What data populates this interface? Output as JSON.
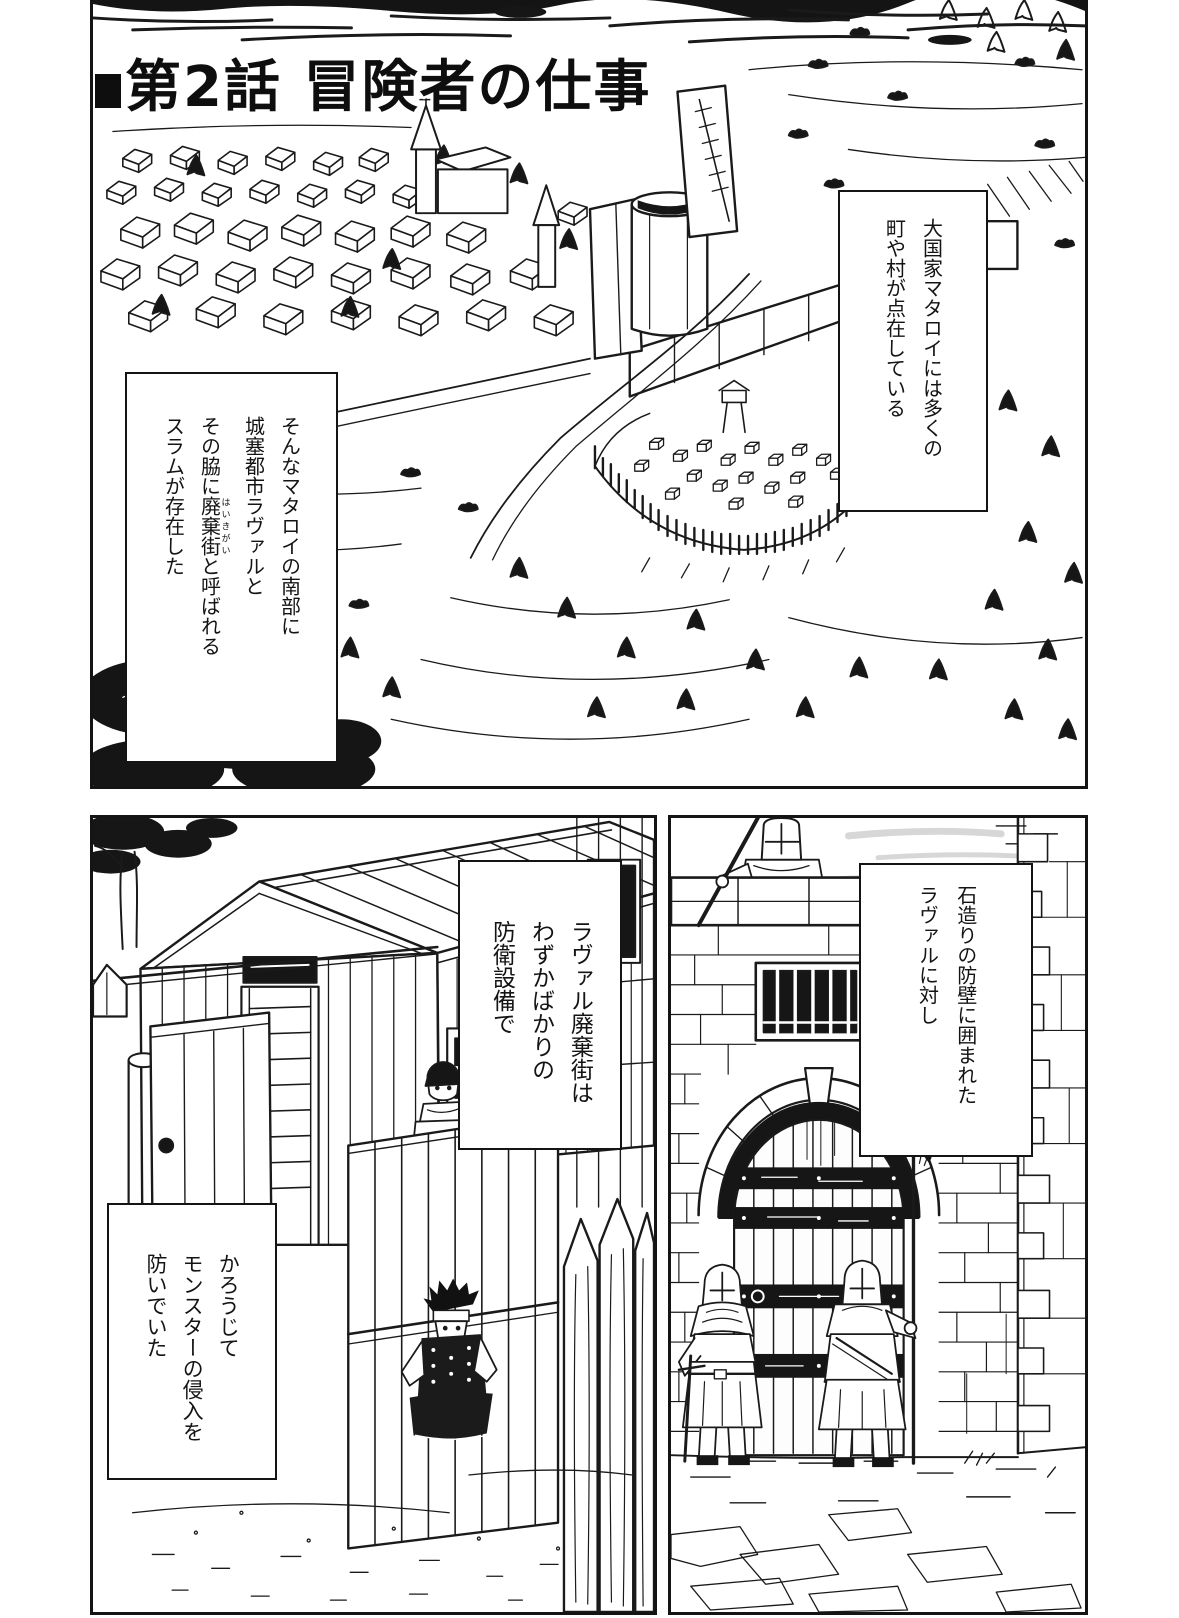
{
  "page": {
    "title": "第2話 冒険者の仕事"
  },
  "colors": {
    "ink": "#141414",
    "paper": "#ffffff"
  },
  "panels": {
    "top": {
      "caption_right": {
        "lines": [
          "大国家マタロイには多くの",
          "町や村が点在している"
        ]
      },
      "caption_left": {
        "l1": "そんなマタロイの南部に",
        "l2": "城塞都市ラヴァルと",
        "l3_pre": "その脇に",
        "l3_base": "廃棄街",
        "l3_ruby": "はいきがい",
        "l3_post": "と呼ばれる",
        "l4": "スラムが存在した"
      }
    },
    "bottom_left": {
      "caption_upper": {
        "lines": [
          "ラヴァル廃棄街は",
          "わずかばかりの",
          "防衛設備で"
        ]
      },
      "caption_lower": {
        "lines": [
          "かろうじて",
          "モンスターの侵入を",
          "防いでいた"
        ]
      }
    },
    "bottom_right": {
      "caption": {
        "lines": [
          "石造りの防壁に囲まれた",
          "ラヴァルに対し"
        ]
      }
    }
  }
}
